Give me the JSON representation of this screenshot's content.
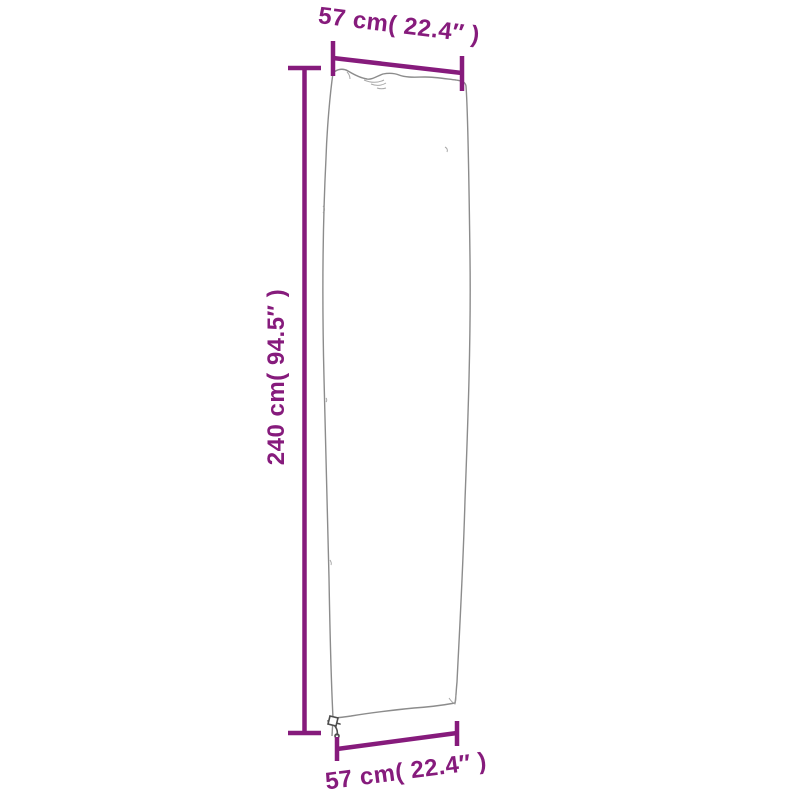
{
  "diagram": {
    "labels": {
      "top": "57 cm( 22.4″ )",
      "side": "240 cm( 94.5″ )",
      "bottom": "57 cm( 22.4″ )"
    },
    "measurements": {
      "width": {
        "cm": 57,
        "inches": 22.4
      },
      "height": {
        "cm": 240,
        "inches": 94.5
      }
    },
    "colors": {
      "dimension": "#861b7c",
      "outline": "#8c8c8c",
      "detail": "#9a9a9a",
      "zipper": "#4d4d4d",
      "background": "#ffffff"
    },
    "icons": {
      "zipper_pull": "zipper-pull-icon"
    }
  }
}
